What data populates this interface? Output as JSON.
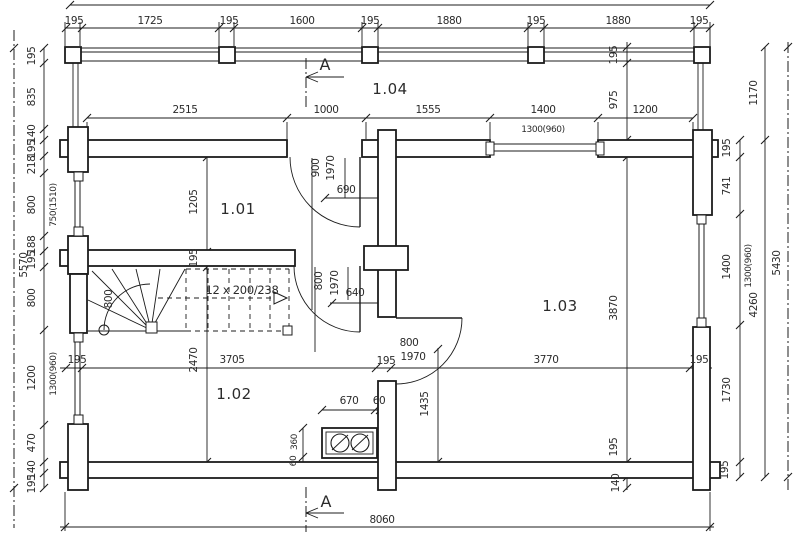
{
  "drawing_type": "floor-plan",
  "section_label": "A",
  "rooms": {
    "r101": "1.01",
    "r102": "1.02",
    "r103": "1.03",
    "r104": "1.04"
  },
  "stair": {
    "steps": "12 x 200/238",
    "walkline": "800"
  },
  "dims": {
    "top_row": [
      "195",
      "1725",
      "195",
      "1600",
      "195",
      "1880",
      "195",
      "1880",
      "195"
    ],
    "second_row": [
      "2515",
      "1000",
      "1555",
      "1400",
      "1200"
    ],
    "top_window": "1300(960)",
    "mid_row": [
      "195",
      "3705",
      "195",
      "3770",
      "195"
    ],
    "bottom_total": "8060",
    "left_col": [
      "195",
      "835",
      "140",
      "195",
      "218",
      "800",
      "188",
      "195",
      "800",
      "1200",
      "470",
      "140",
      "195"
    ],
    "left_total": "5570",
    "left_window_upper": "750(1510)",
    "left_window_lower": "1300(960)",
    "room1_height": "1205",
    "stair_wall": "195",
    "room2_height": "2470",
    "hall_height": "3870",
    "hall_wall": "195",
    "hall_below": "140",
    "beam": "195",
    "terrace_gap": "975",
    "terrace_height": "1170",
    "right_col": [
      "195",
      "741",
      "1400",
      "1730",
      "195"
    ],
    "right_window": "1300(960)",
    "right_inner_total": "4260",
    "right_total": "5430",
    "door1_w": "900",
    "door1_h": "1970",
    "door1_clear": "690",
    "door2_w": "800",
    "door2_h": "1970",
    "door2_clear": "640",
    "door3_w": "800",
    "door3_h": "1970",
    "door3_clear": "1435",
    "stove_w": "670",
    "stove_gap_right": "60",
    "stove_d": "360",
    "stove_gap_bottom": "60"
  }
}
